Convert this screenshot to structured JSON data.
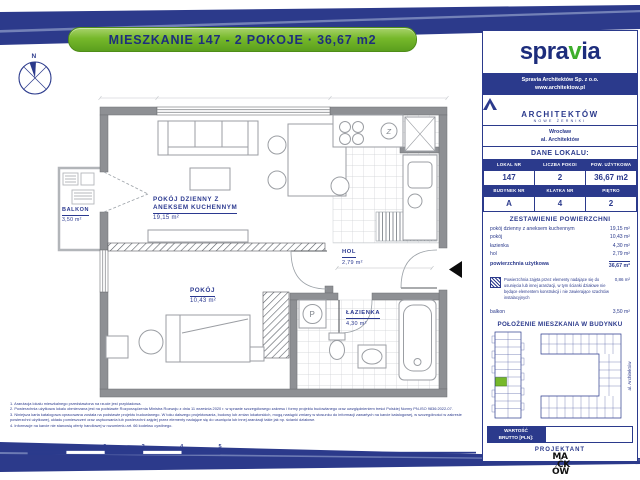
{
  "header": {
    "badge_text": "MIESZKANIE 147 - 2 POKOJE · 36,67 m2"
  },
  "compass": {
    "north_label": "N"
  },
  "plan": {
    "rooms": {
      "living": {
        "name_line1": "POKÓJ DZIENNY Z",
        "name_line2": "ANEKSEM KUCHENNYM",
        "area": "19,15 m²"
      },
      "bedroom": {
        "name": "POKÓJ",
        "area": "10,43 m²"
      },
      "hall": {
        "name": "HOL",
        "area": "2,79 m²"
      },
      "bathroom": {
        "name": "ŁAZIENKA",
        "area": "4,30 m²"
      },
      "balcony": {
        "name": "BALKON",
        "area": "3,50 m²"
      }
    },
    "symbols": {
      "washing_machine": "P",
      "dishwasher": "Z"
    }
  },
  "scale_bar": {
    "ticks": [
      "0",
      "1",
      "2",
      "3",
      "4",
      "5"
    ]
  },
  "footnotes": [
    "1. Aranżacja lokalu mieszkalnego przedstawiona na rzucie jest przykładowa.",
    "2. Powierzchnia użytkowa lokalu obmierzana jest na podstawie Rozporządzenia Ministra Rozwoju z dnia 11 września 2020 r. w sprawie szczegółowego zakresu i formy projektu budowlanego oraz uwzględnieniem treści Polskiej Normy PN-ISO 9836:2022-07.",
    "3. Niniejsza karta katalogowa opracowana została na podstawie projektu budowlanego. W toku dalszego projektowania, budowy lub zmian lokatorskich, mogą nastąpić zmiany w stosunku do informacji zawartych na karcie katalogowej, w szczególności w zakresie powierzchni użytkowej, układu pomieszczeń oraz usytuowania lub powierzchni zajętej przez elementy nadające się do usunięcia lub innej aranżacji takie jak np. ścianki działowe.",
    "4. Informacje na karcie nie stanowią oferty handlowej w rozumieniu art. 66 kodeksu cywilnego."
  ],
  "sidebar": {
    "brand": {
      "logo_prefix": "spra",
      "logo_v": "v",
      "logo_suffix": "ia"
    },
    "company_box": {
      "line1": "Spravia Architektów Sp. z o.o.",
      "line2": "www.architektow.pl"
    },
    "development": {
      "name": "ARCHITEKTÓW",
      "tagline": "NOWE ŻERNIKI",
      "city": "Wrocław",
      "address": "al. Architektów"
    },
    "unit_data": {
      "title": "DANE LOKALU:",
      "row1_headers": [
        "LOKAL NR",
        "LICZBA POKOI",
        "POW. UŻYTKOWA"
      ],
      "row1_values": [
        "147",
        "2",
        "36,67 m2"
      ],
      "row2_headers": [
        "BUDYNEK NR",
        "KLATKA NR",
        "PIĘTRO"
      ],
      "row2_values": [
        "A",
        "4",
        "2"
      ]
    },
    "areas": {
      "title": "ZESTAWIENIE POWIERZCHNI",
      "items": [
        {
          "label": "pokój dzienny z aneksem kuchennym",
          "value": "19,15 m²"
        },
        {
          "label": "pokój",
          "value": "10,43 m²"
        },
        {
          "label": "łazienka",
          "value": "4,30 m²"
        },
        {
          "label": "hol",
          "value": "2,79 m²"
        }
      ],
      "total_label": "powierzchnia użytkowa",
      "total_value": "36,67 m²",
      "note_text": "Powierzchnia zajęta przez elementy nadające się do usunięcia lub innej aranżacji, w tym ścianki działowe nie będące elementem konstrukcji i nie zawierające szachtów instalacyjnych",
      "note_value": "0,86 m²",
      "balcony_label": "balkon",
      "balcony_value": "3,50 m²"
    },
    "location": {
      "title": "POŁOŻENIE MIESZKANIA W BUDYNKU",
      "street": "al. Architektów"
    },
    "price": {
      "label_line1": "WARTOŚĆ",
      "label_line2": "BRUTTO [PLN]:"
    },
    "designer": {
      "title": "PROJEKTANT",
      "logo_line1": "MA",
      "logo_line2": "ĆK",
      "logo_line3": "ÓW"
    }
  },
  "colors": {
    "navy": "#2b3a8c",
    "green": "#76b82a",
    "wall_gray": "#8e9094",
    "black": "#0c0c0c"
  }
}
